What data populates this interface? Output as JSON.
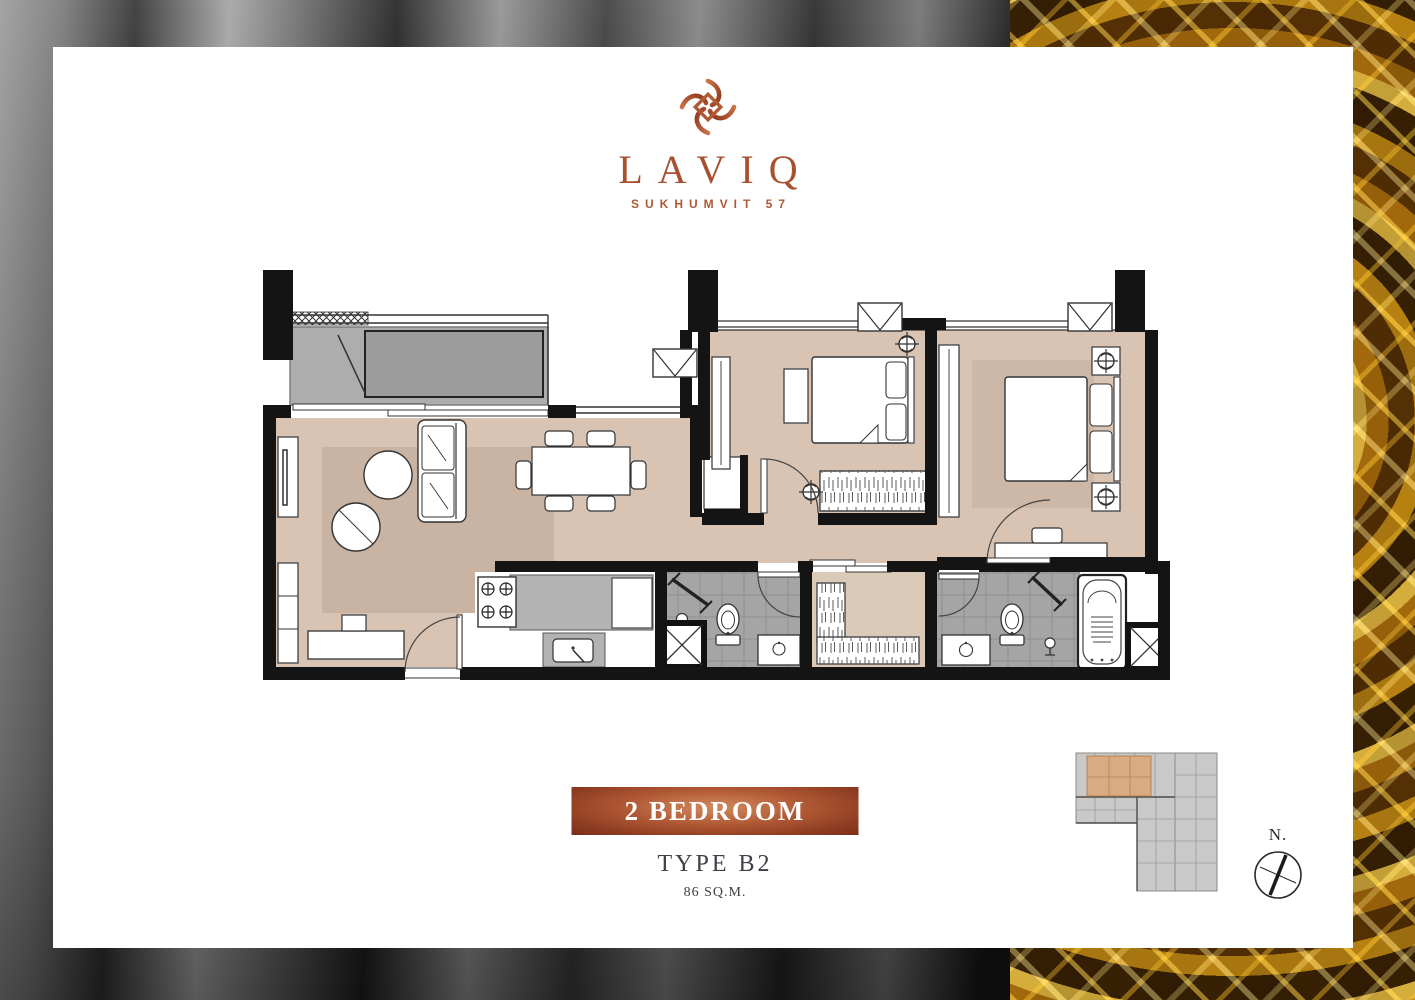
{
  "brand": {
    "name": "LAVIQ",
    "subtitle": "SUKHUMVIT 57"
  },
  "unit": {
    "banner_label": "2 BEDROOM",
    "type_label": "TYPE B2",
    "area_label": "86 SQ.M."
  },
  "compass": {
    "north_label": "N."
  },
  "colors": {
    "copper_accent": "#a8512f",
    "banner_gradient_center": "#d18a5e",
    "banner_gradient_edge": "#8a3a20",
    "floor_beige": "#d9c4b4",
    "rug_beige": "#c9b3a3",
    "wall_black": "#141414",
    "bath_tile_gray": "#a5a5a5",
    "balcony_gray": "#adadad",
    "keyplan_gray": "#c9c9c9",
    "keyplan_highlight": "#d8ab80",
    "gold_texture": "#c07d0e",
    "silver_texture": "#6f6f6f"
  }
}
